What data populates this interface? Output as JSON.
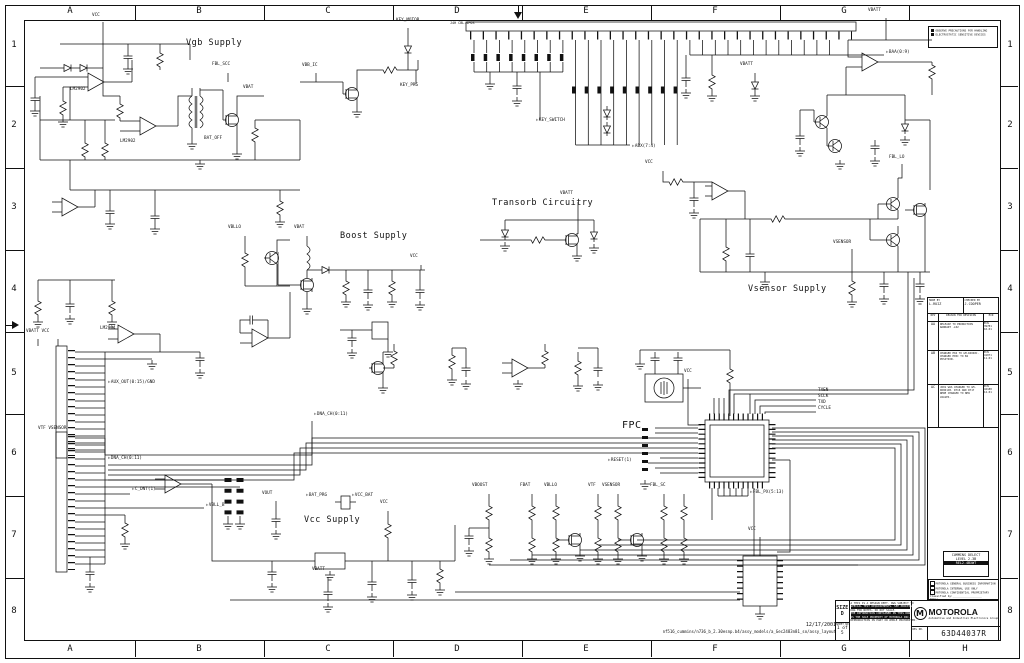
{
  "sheet": {
    "cols_top": [
      "A",
      "B",
      "C",
      "D",
      "E",
      "F",
      "G"
    ],
    "cols_bottom": [
      "A",
      "B",
      "C",
      "D",
      "E",
      "F",
      "G",
      "H"
    ],
    "rows": [
      "1",
      "2",
      "3",
      "4",
      "5",
      "6",
      "7",
      "8"
    ]
  },
  "sections": {
    "vgb": "Vgb Supply",
    "transorb": "Transorb Circuitry",
    "boost": "Boost Supply",
    "vsensor": "Vsensor Supply",
    "vcc": "Vcc Supply",
    "fpc": "FPC"
  },
  "nets": [
    "VCC",
    "VBATT",
    "KEY_MOTOR",
    "KEY_PRG",
    "VBB_IC",
    "FBL_SCC",
    "VBAT",
    "BAT_OFF",
    "J4H CBL-4POS",
    "KEY_SWITCH",
    "ABX(7:4)",
    "BAA(0:9)",
    "VBATT",
    "VBLLO",
    "VBAT",
    "VBATT",
    "FBL_LO",
    "VSENSOR",
    "VCC",
    "VBATT  VCC",
    "VTF  VSENSOR",
    "AUX_OUT(0:15)/GND",
    "DNA_CH(0:11)",
    "DNA_CH(0:11)",
    "C_DNT(1)",
    "VBLL_B",
    "VOUT",
    "BAT_PRG",
    "VCC_BAT",
    "VCC",
    "VBATT",
    "VBOOST",
    "FBAT",
    "VBLLO",
    "VTF",
    "VSENSOR",
    "FBL_SC",
    "FBL_PX(5:13)",
    "LM2902",
    "LM2902",
    "LM2904",
    "VCC",
    "RESET(1)",
    "VCC",
    "TXEN",
    "SCLK",
    "TXD",
    "CYCLE",
    "VCC"
  ],
  "icons": {
    "offpage_arrow": "▷",
    "motorola_m": "M"
  },
  "esd_note": {
    "line1": "OBSERVE PRECAUTIONS FOR HANDLING",
    "line2": "ELECTROSTATIC SENSITIVE DEVICES"
  },
  "revision_table": {
    "made_by_label": "MADE BY",
    "made_by": "L.RUIZ",
    "checked_by_label": "CHECKED BY",
    "checked_by": "J.COOPER",
    "col_rev": "REV",
    "col_desc": "REASON FOR REVISION",
    "col_ecn": "ECN",
    "rows": [
      {
        "rev": "AA",
        "desc": "RELEASE TO PRODUCTION WARRANT -L02",
        "ecn": "ECN 39781 10-01"
      },
      {
        "rev": "AB",
        "desc": "CHANGED E04 TO GM-D4048C. CHANGED E05C TO B4 POSITION.",
        "ecn": "ECN 41071 11-01"
      },
      {
        "rev": "AC",
        "desc": "J601 WAS CHANGED TO GM-D6061JB. R716 AND R717 WERE CHANGED TO NEW VALUES.",
        "ecn": "ECN 42188 12-01"
      }
    ]
  },
  "project_box": {
    "line1": "CUMMINS DELECT",
    "line2": "LEVEL 2.3B",
    "line3": "REL2-4BXWT"
  },
  "classification": {
    "opt1": "MOTOROLA GENERAL BUSINESS INFORMATION",
    "opt2": "MOTOROLA INTERNAL USE ONLY",
    "opt3": "MOTOROLA CONFIDENTIAL PROPRIETARY",
    "classified_by": "Classified by:__________________",
    "date_label": "Date:__________________"
  },
  "title_block": {
    "size_label": "SIZE D",
    "sheet_no_label": "SHEET_NO",
    "sheet_no": "1 of 5",
    "legal_1": "A THIS IS A DESIGN DEPT. DWG SUBJECT TO",
    "legal_2": "SPECIAL TEST REQUIREMENTS. SEE PROCESS",
    "legal_3": "DWG FOR NOTES. DO NOT SCALE.",
    "legal_4": "THE INFORMATION CONTAINED IN THIS DWG",
    "legal_5": "IS THE SOLE PROPERTY OF MOTOROLA INC.",
    "legal_6": "REPRODUCTION IN PART OR WHOLE PROHIBITED.",
    "company": "MOTOROLA",
    "company_sub": "Automotive and Industrial Electronics Group",
    "rel_label": "REL NO.",
    "part_number": "63D44037R",
    "date": "12/17/2001",
    "file_path": "nf516_cummins/n736_b_2.30esnp.b4/assy_models/a_Gec2483n81_so/assy_layout"
  }
}
